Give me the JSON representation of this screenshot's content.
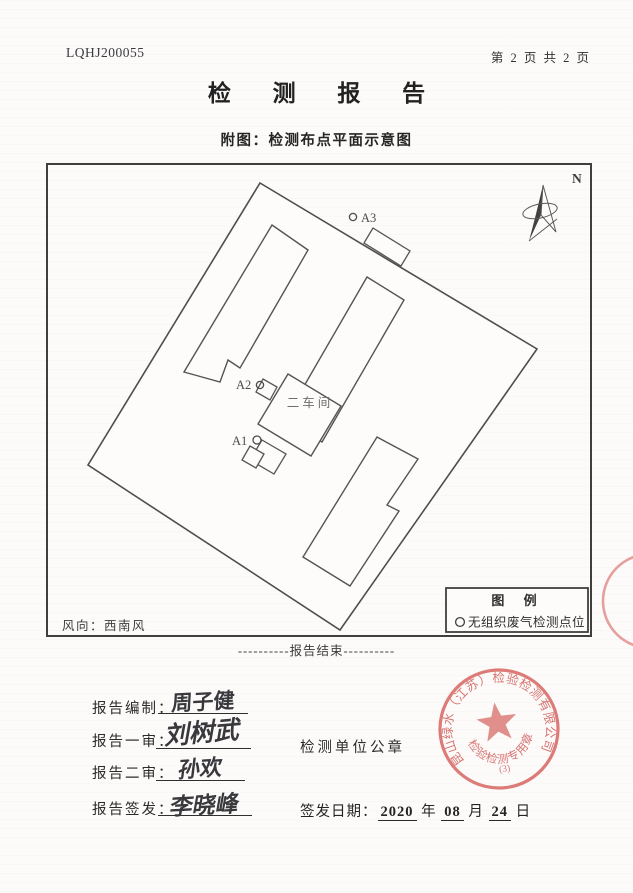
{
  "page": {
    "report_no": "LQHJ200055",
    "page_indicator": "第 2 页 共 2 页",
    "title": "检 测 报 告",
    "figure_caption": "附图：检测布点平面示意图",
    "end_of_report": "----------报告结束----------"
  },
  "diagram": {
    "north": "N",
    "workshop": "二车间",
    "points": [
      {
        "id": "A1"
      },
      {
        "id": "A2"
      },
      {
        "id": "A3"
      }
    ],
    "legend": {
      "title": "图 例",
      "item": "无组织废气检测点位"
    },
    "wind": "风向：西南风"
  },
  "form": {
    "rows": [
      {
        "label": "报告编制：",
        "signature": "周子健"
      },
      {
        "label": "报告一审：",
        "signature": "刘树武"
      },
      {
        "label": "报告二审：",
        "signature": "孙欢"
      },
      {
        "label": "报告签发：",
        "signature": "李晓峰"
      }
    ],
    "seal_caption": "检测单位公章",
    "date": {
      "label": "签发日期：",
      "year": "2020",
      "year_unit": "年",
      "month": "08",
      "month_unit": "月",
      "day": "24",
      "day_unit": "日"
    }
  },
  "stamp": {
    "company": "昆山绿水（江苏）检验检测有限公司",
    "seal_type": "检验检测专用章",
    "seal_number": "(3)",
    "color": "#d5605c"
  }
}
